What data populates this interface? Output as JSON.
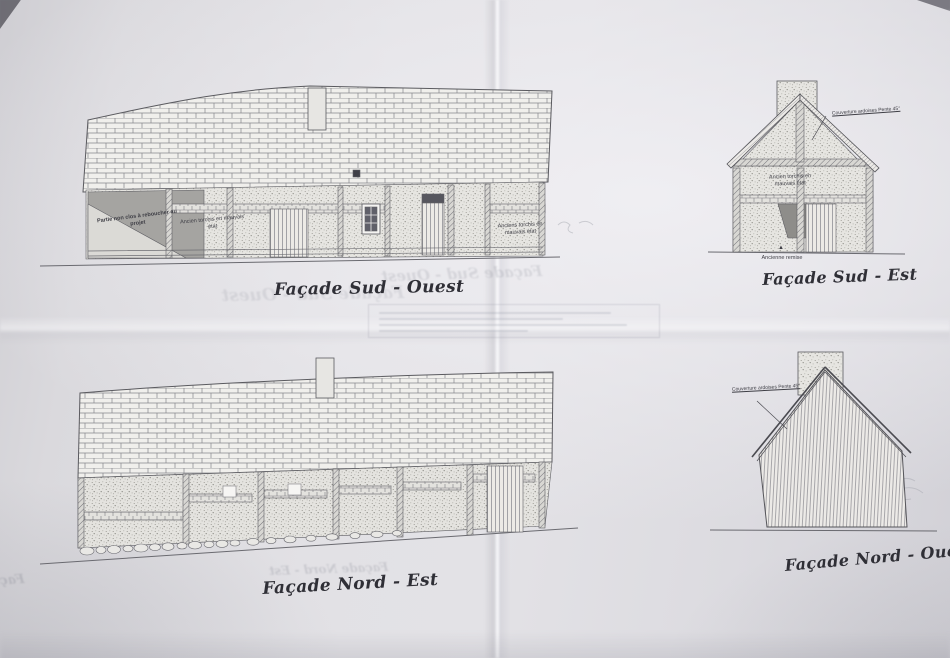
{
  "captions": {
    "sud_ouest": "Façade Sud - Ouest",
    "sud_est": "Façade Sud - Est",
    "nord_est": "Façade Nord - Est",
    "nord_ouest": "Façade Nord - Ouest"
  },
  "annotations": {
    "wall_patch": "Partie non clos à reboucher au projet",
    "torchis_left": "Ancien torchis en mauvais état",
    "torchis_right": "Anciens torchis en mauvais état",
    "torchis_gable": "Ancien torchis en mauvais état",
    "slate_sud_est": "Couverture ardoises Pente 45°",
    "slate_nord_ouest": "Couverture ardoises Pente 45°",
    "remise": "Ancienne remise",
    "remise_arrow": "▲"
  },
  "colors": {
    "paper": "#dcdbe0",
    "drawing_line": "#55555a",
    "caption_ink": "#2f2f36"
  }
}
